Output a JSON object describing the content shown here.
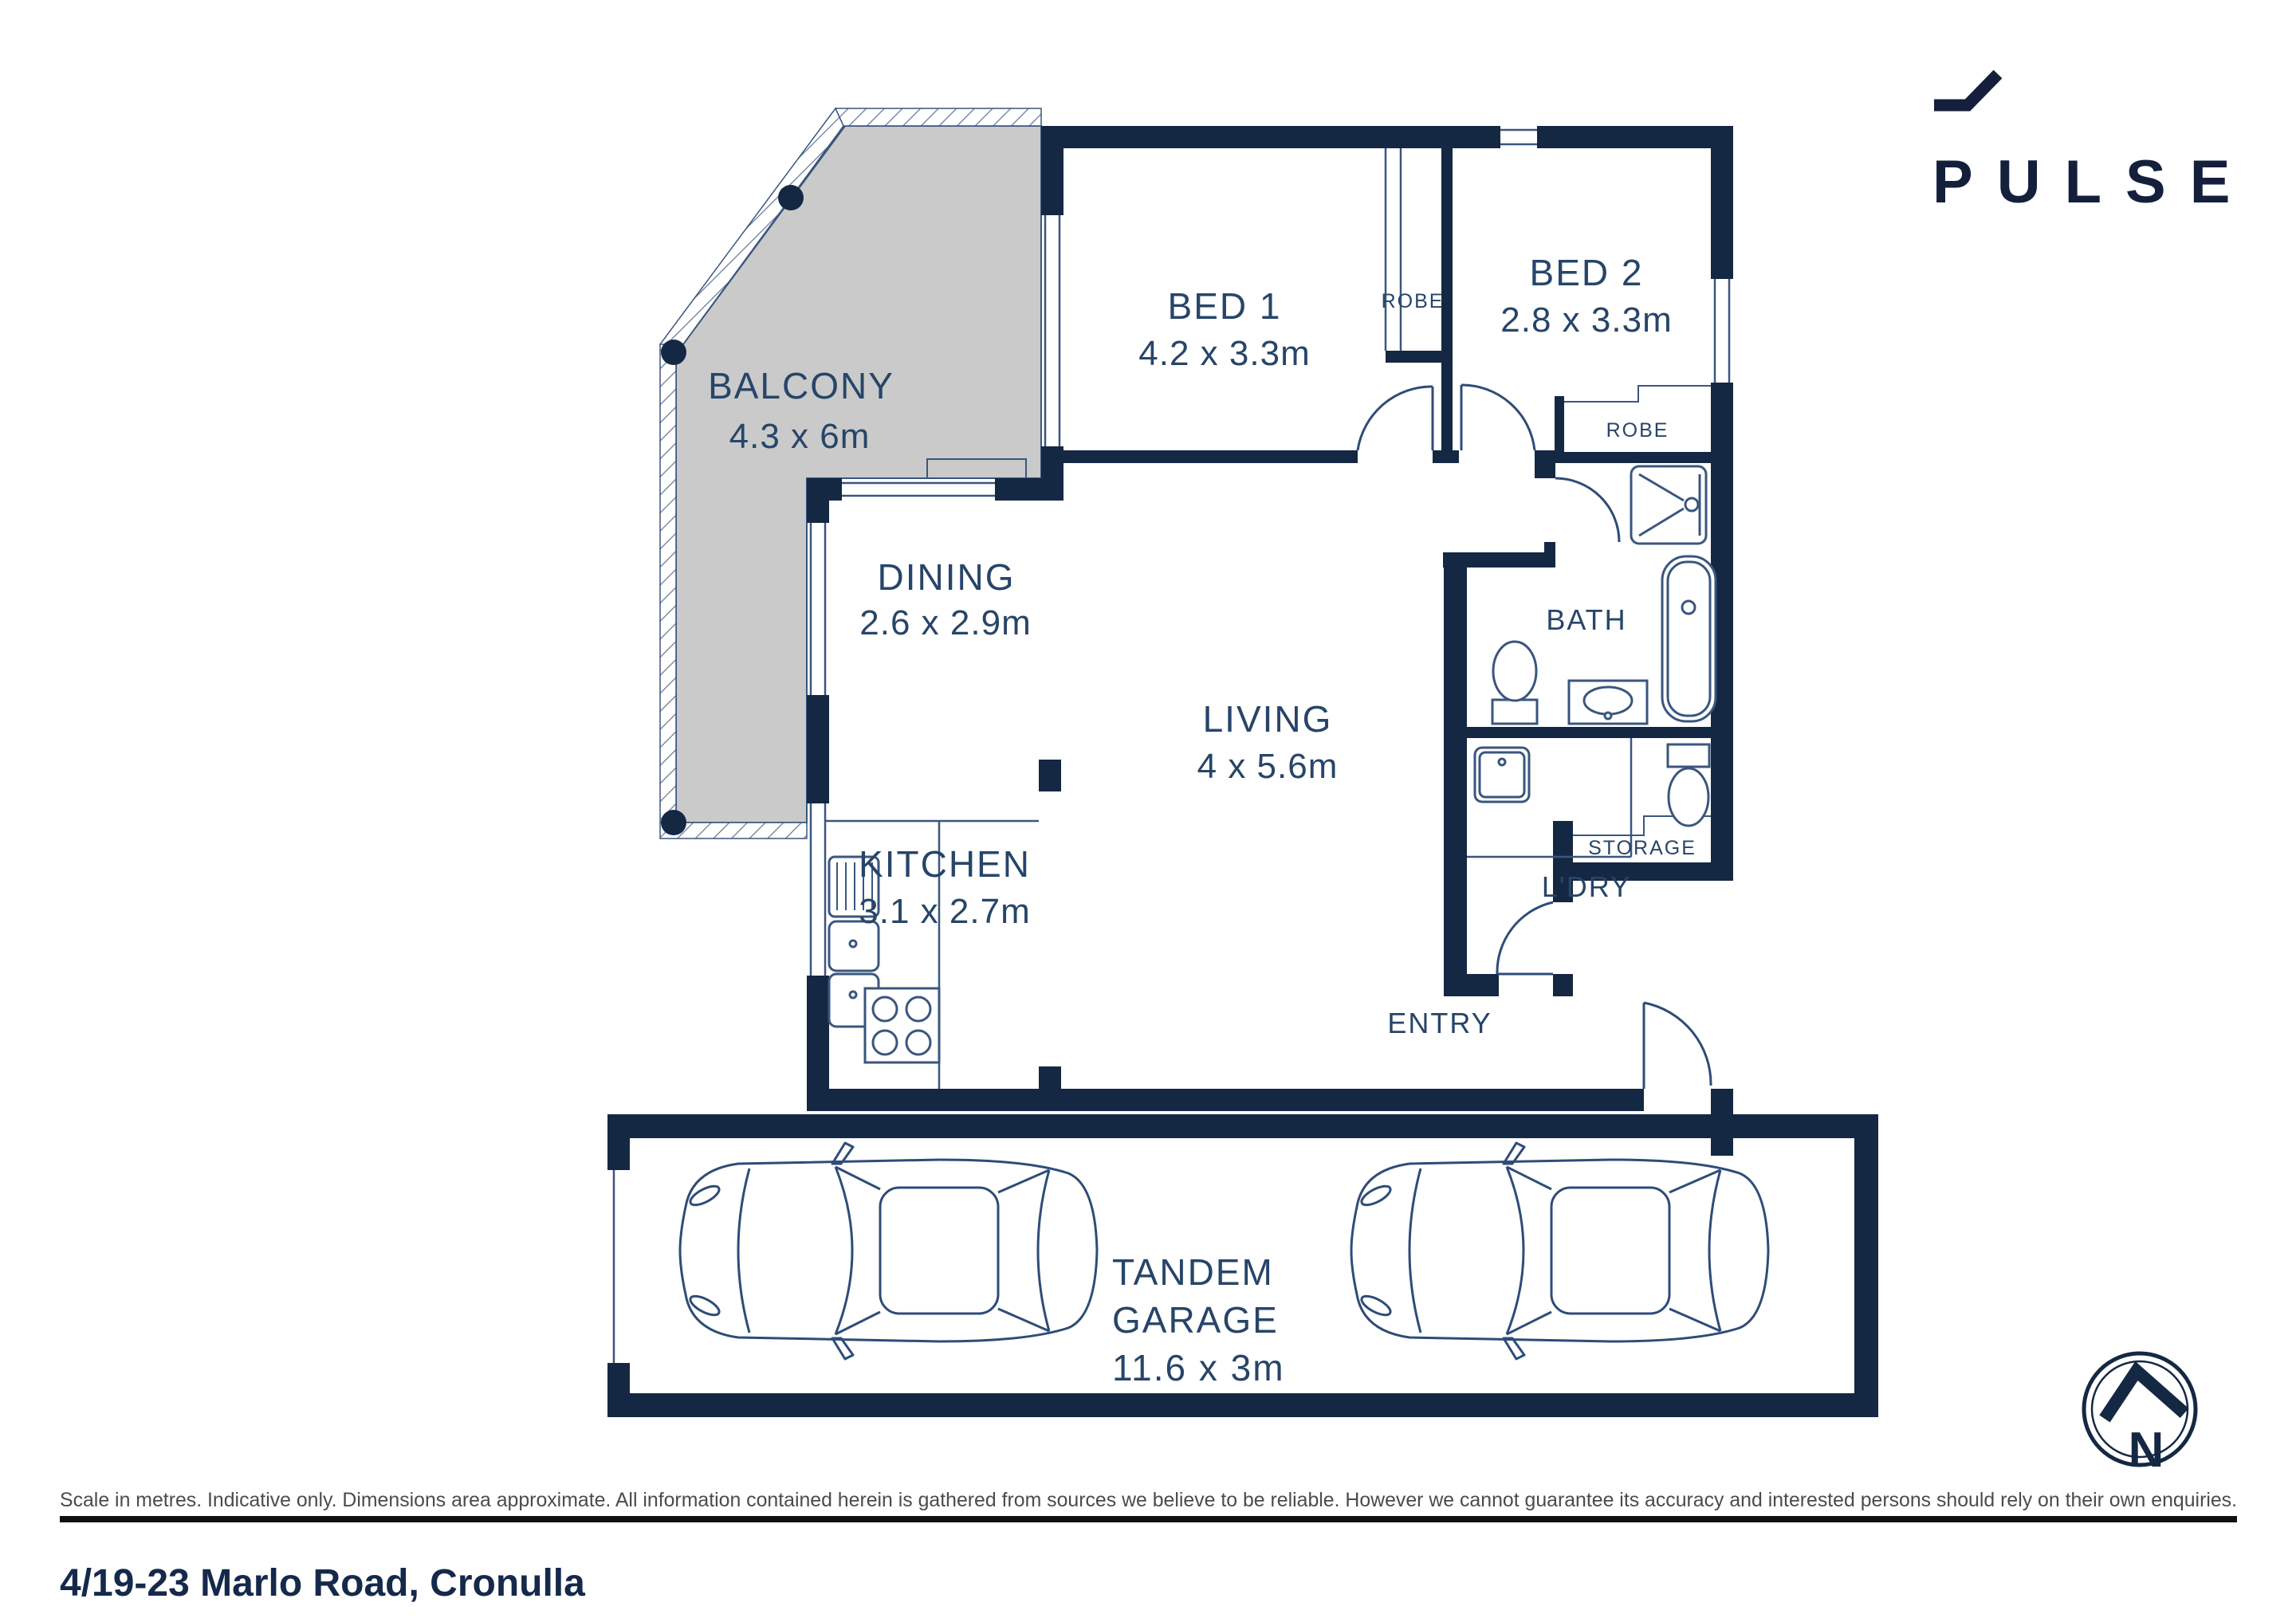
{
  "logo": {
    "name": "PULSE"
  },
  "plan": {
    "balcony": {
      "label": "BALCONY",
      "dims": "4.3 x 6m"
    },
    "bed1": {
      "label": "BED 1",
      "dims": "4.2 x 3.3m"
    },
    "bed2": {
      "label": "BED 2",
      "dims": "2.8 x 3.3m"
    },
    "dining": {
      "label": "DINING",
      "dims": "2.6 x 2.9m"
    },
    "kitchen": {
      "label": "KITCHEN",
      "dims": "3.1 x 2.7m"
    },
    "living": {
      "label": "LIVING",
      "dims": "4 x 5.6m"
    },
    "bath": {
      "label": "BATH"
    },
    "laundry": {
      "label": "L'DRY"
    },
    "entry": {
      "label": "ENTRY"
    },
    "storage": {
      "label": "STORAGE"
    },
    "robe1": {
      "label": "ROBE"
    },
    "robe2": {
      "label": "ROBE"
    },
    "garage": {
      "label_line1": "TANDEM",
      "label_line2": "GARAGE",
      "dims": "11.6 x 3m"
    }
  },
  "compass": {
    "label": "N"
  },
  "footer": {
    "disclaimer": "Scale in metres. Indicative only. Dimensions area approximate. All information contained herein is gathered from sources we believe to be reliable. However we cannot guarantee its accuracy and interested persons should rely on their own enquiries.",
    "address": "4/19-23 Marlo Road, Cronulla"
  },
  "colors": {
    "wall": "#142844",
    "thin_line": "#3a567e",
    "label": "#274569",
    "balcony_fill": "#cacaca",
    "logo": "#141f3c"
  }
}
